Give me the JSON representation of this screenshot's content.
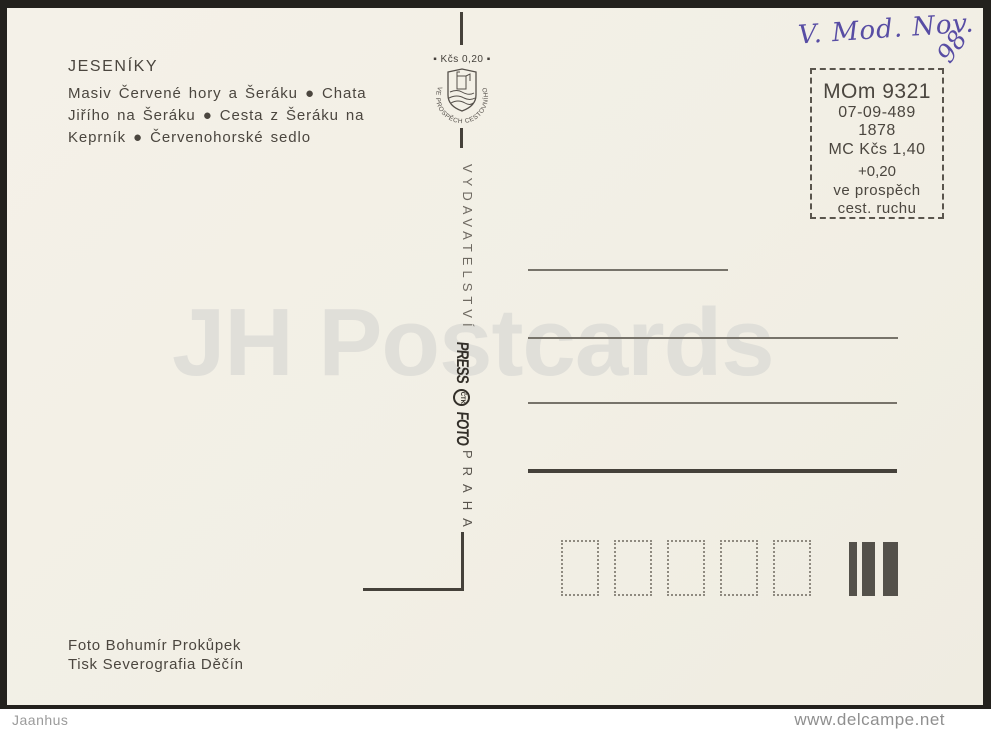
{
  "postcard": {
    "title": "JESENÍKY",
    "caption_lines": [
      "Masiv Červené hory a Šeráku ● Chata",
      "Jiřího na Šeráku ● Cesta z Šeráku na",
      "Keprník ● Červenohorské sedlo"
    ],
    "stamp": {
      "value_label": "▪ Kčs  0,20 ▪",
      "ring_text": "VE PROSPĚCH CESTOVNÍHO RUCHU"
    },
    "publisher_vertical": "VYDAVATELSTVÍ",
    "press_logo": {
      "press": "PRESS",
      "ctk": "ČTK",
      "foto": "FOTO"
    },
    "city_vertical": "PRAHA",
    "handwriting": {
      "text": "V. Mod. Nov.",
      "year": "98"
    },
    "info_box": {
      "lines": [
        "MOm 9321",
        "07-09-489",
        "1878",
        "MC Kčs 1,40",
        "+0,20",
        "ve prospěch",
        "cest. ruchu"
      ]
    },
    "credits": [
      "Foto Bohumír Prokůpek",
      "Tisk Severografia Děčín"
    ],
    "watermark": "JH Postcards",
    "postal_code_box_count": 5
  },
  "footer": {
    "left": "Jaanhus",
    "right": "www.delcampe.net"
  },
  "colors": {
    "card_background": "#f2efe6",
    "card_edge": "#23211d",
    "ink_text": "#4b463f",
    "handwriting_ink": "#584da4",
    "watermark": "#e0dfd9",
    "line": "#77736a"
  }
}
